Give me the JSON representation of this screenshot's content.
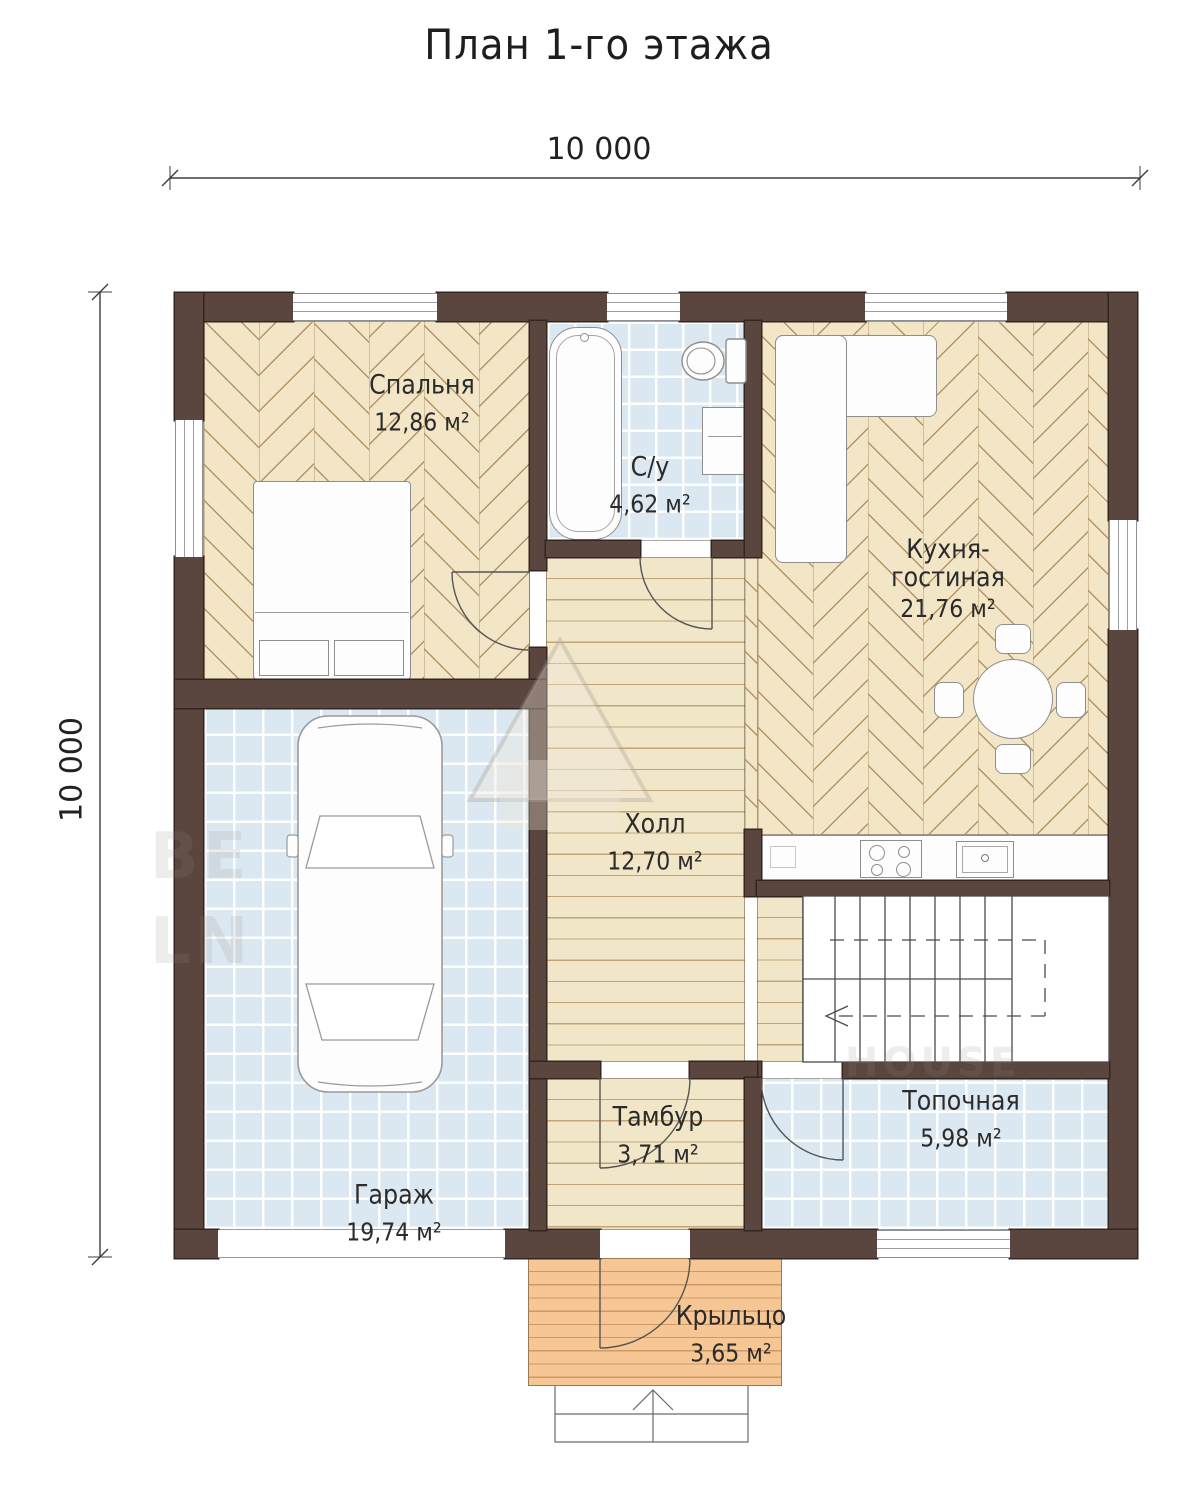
{
  "title": "План 1-го этажа",
  "dims": {
    "width_label": "10 000",
    "height_label": "10 000"
  },
  "rooms": {
    "bedroom": {
      "label": "Спальня",
      "area": "12,86 м²"
    },
    "bathroom": {
      "label": "С/у",
      "area": "4,62 м²"
    },
    "kitchen": {
      "label1": "Кухня-",
      "label2": "гостиная",
      "area": "21,76 м²"
    },
    "hall": {
      "label": "Холл",
      "area": "12,70 м²"
    },
    "garage": {
      "label": "Гараж",
      "area": "19,74 м²"
    },
    "vestibule": {
      "label": "Тамбур",
      "area": "3,71 м²"
    },
    "boiler": {
      "label": "Топочная",
      "area": "5,98 м²"
    },
    "porch": {
      "label": "Крыльцо",
      "area": "3,65 м²"
    }
  },
  "watermark": {
    "f1": "BE",
    "f2": "LN",
    "f3": "HOUSE"
  },
  "colors": {
    "wall": "#5a463e",
    "wall_edge": "#33261f",
    "parquet": "#f3e6c6",
    "parquet_line": "#b3936a",
    "plank": "#f2e6c9",
    "plank_line": "#c2a577",
    "deck": "#f6c795",
    "deck_line": "#cd9a63",
    "tile": "#dce8f1",
    "ink": "#2a2a2a"
  }
}
